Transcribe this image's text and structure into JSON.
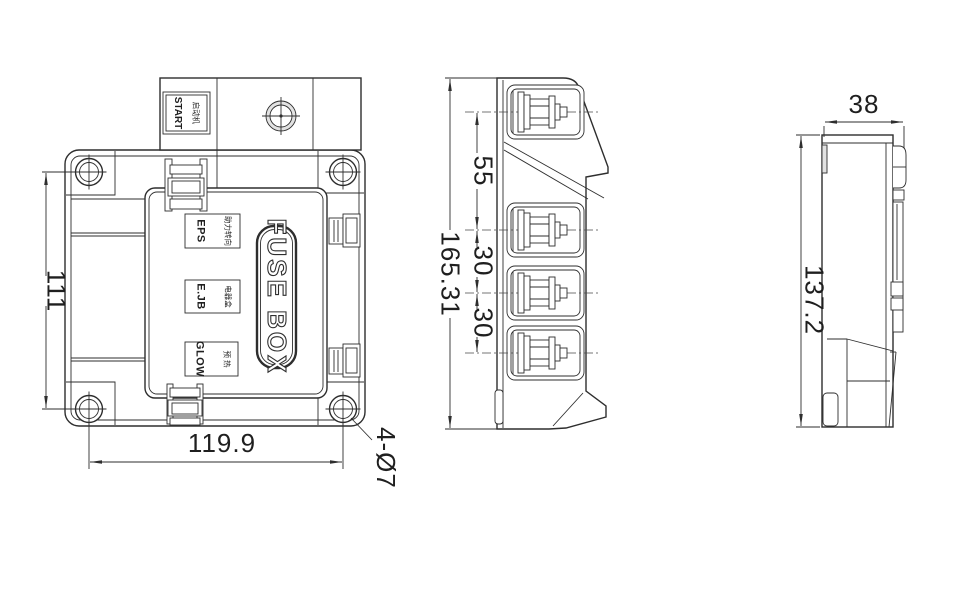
{
  "front_view": {
    "start_label": {
      "cn": "启动机",
      "en": "START"
    },
    "relay_labels": [
      {
        "cn": "助力转向",
        "en": "EPS"
      },
      {
        "cn": "电器盒",
        "en": "E.JB"
      },
      {
        "cn": "预 热",
        "en": "GLOW"
      }
    ],
    "cover_label": "FUSE BOX",
    "dims": {
      "height": "111",
      "width": "119.9",
      "holes": "4-Ø7"
    }
  },
  "side_view": {
    "dims": {
      "overall_height": "165.31",
      "stud_gap_1": "55",
      "stud_gap_2": "30",
      "stud_gap_3": "30"
    }
  },
  "profile_view": {
    "dims": {
      "depth": "38",
      "height": "137.2"
    }
  },
  "colors": {
    "line": "#2e2e2e",
    "background": "#ffffff"
  }
}
